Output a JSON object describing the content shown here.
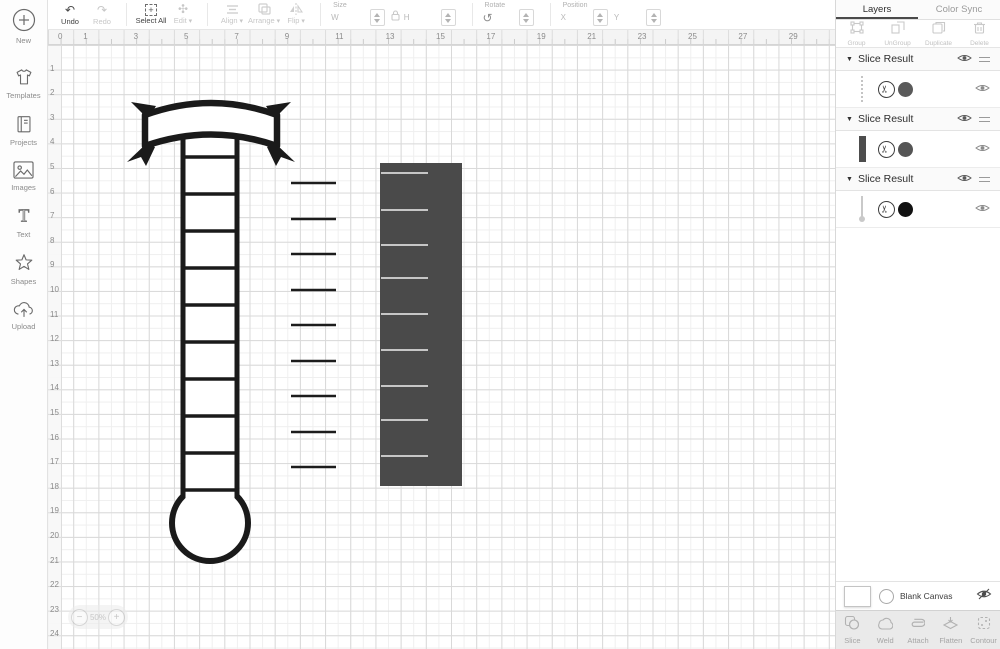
{
  "app": {
    "title": "Design Space Canvas"
  },
  "sidebar": {
    "items": [
      {
        "id": "new",
        "label": "New"
      },
      {
        "id": "templates",
        "label": "Templates"
      },
      {
        "id": "projects",
        "label": "Projects"
      },
      {
        "id": "images",
        "label": "Images"
      },
      {
        "id": "text",
        "label": "Text"
      },
      {
        "id": "shapes",
        "label": "Shapes"
      },
      {
        "id": "upload",
        "label": "Upload"
      }
    ]
  },
  "toolbar": {
    "undo": "Undo",
    "redo": "Redo",
    "select_all": "Select All",
    "edit": "Edit",
    "align": "Align",
    "arrange": "Arrange",
    "flip": "Flip",
    "size": {
      "label": "Size",
      "w": "W",
      "h": "H"
    },
    "rotate": {
      "label": "Rotate"
    },
    "position": {
      "label": "Position",
      "x": "X",
      "y": "Y"
    }
  },
  "rulers": {
    "horizontal": [
      0,
      1,
      3,
      5,
      7,
      9,
      11,
      13,
      15,
      17,
      19,
      21,
      23,
      25,
      27,
      29
    ],
    "vertical": [
      1,
      2,
      3,
      4,
      5,
      6,
      7,
      8,
      9,
      10,
      11,
      12,
      13,
      14,
      15,
      16,
      17,
      18,
      19,
      20,
      21,
      22,
      23,
      24
    ]
  },
  "canvas": {
    "zoom": {
      "minus": "−",
      "value": "50%",
      "plus": "+"
    },
    "shapes": {
      "thermometer": {
        "stroke": "#1a1a1a",
        "tube_left": 135,
        "tube_right": 189,
        "tube_top": 73,
        "bulb_cx": 162,
        "bulb_cy": 478,
        "bulb_r": 38,
        "rung_ys": [
          112,
          149,
          186,
          223,
          260,
          297,
          334,
          371,
          408,
          445
        ]
      },
      "tick_lines": {
        "x1": 243,
        "x2": 288,
        "stroke": "#1c1c1c",
        "ys": [
          138,
          174,
          209,
          245,
          280,
          316,
          351,
          387,
          422
        ]
      },
      "slice_rect": {
        "x": 332,
        "y": 118,
        "w": 82,
        "h": 323,
        "fill": "#4a4a4a",
        "tick_x1": 333,
        "tick_x2": 380,
        "tick_color": "#c6c6c6",
        "tick_ys": [
          128,
          165,
          200,
          233,
          269,
          305,
          341,
          375,
          411
        ]
      }
    }
  },
  "layers_panel": {
    "tabs": [
      {
        "label": "Layers",
        "active": true
      },
      {
        "label": "Color Sync",
        "active": false
      }
    ],
    "actions": [
      "Group",
      "UnGroup",
      "Duplicate",
      "Delete"
    ],
    "groups": [
      {
        "header": "Slice Result",
        "layer": {
          "thumb": "dashed-line",
          "color": "#5a5a5a"
        }
      },
      {
        "header": "Slice Result",
        "layer": {
          "thumb": "solid-bar",
          "color": "#555555"
        }
      },
      {
        "header": "Slice Result",
        "layer": {
          "thumb": "thermometer",
          "color": "#111111"
        }
      }
    ],
    "blank_canvas_label": "Blank Canvas",
    "bottom_actions": [
      "Slice",
      "Weld",
      "Attach",
      "Flatten",
      "Contour"
    ]
  }
}
